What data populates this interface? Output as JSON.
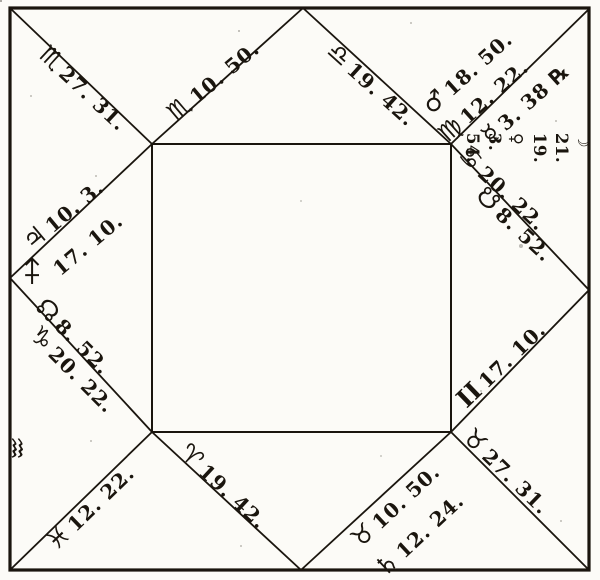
{
  "figure": {
    "kind": "square-horoscope-figure",
    "ink_color": "#1a150e",
    "paper_color": "#fcfbf7"
  },
  "cusps": {
    "corner_tl": {
      "sign": "♏",
      "deg": "27. 31."
    },
    "top_left": {
      "sign": "♏",
      "deg": "10. 50."
    },
    "top_right": {
      "sign": "♎",
      "deg": "19. 42."
    },
    "corner_tr": {
      "sign": "♍",
      "deg": "12. 22."
    },
    "right_upper": {
      "sign": "♋",
      "deg": "20. 22."
    },
    "right_lower": {
      "sign": "II",
      "deg": "17. 10."
    },
    "corner_br": {
      "sign": "♉",
      "deg": "27. 31."
    },
    "bottom_right": {
      "sign": "♉",
      "deg": "10. 50."
    },
    "bottom_left": {
      "sign": "♈",
      "deg": "19. 42."
    },
    "corner_bl": {
      "sign": "♓",
      "deg": "12. 22."
    },
    "left_lower": {
      "sign": "♑",
      "deg": "20. 22."
    },
    "ascendant": {
      "sign": "♐",
      "deg": "17. 10."
    }
  },
  "planets": {
    "jupiter": {
      "sign": "♃",
      "deg": "10. 3."
    },
    "mars": {
      "sign": "♂",
      "deg": "18. 50."
    },
    "mercury": {
      "sign": "☿",
      "deg": "3. 38 ℞"
    },
    "saturn": {
      "sign": "♄",
      "deg": "12. 24."
    },
    "north_node": {
      "sign": "☊",
      "deg": "8. 52."
    },
    "south_node": {
      "sign": "☋",
      "deg": "8. 52."
    },
    "intercepted_sign": "♒",
    "leo_group": {
      "sign": "♌",
      "sun": "☉ 27. 20.",
      "moon": "☽ 21. 19.",
      "venus": "♀ 3. 54."
    }
  }
}
